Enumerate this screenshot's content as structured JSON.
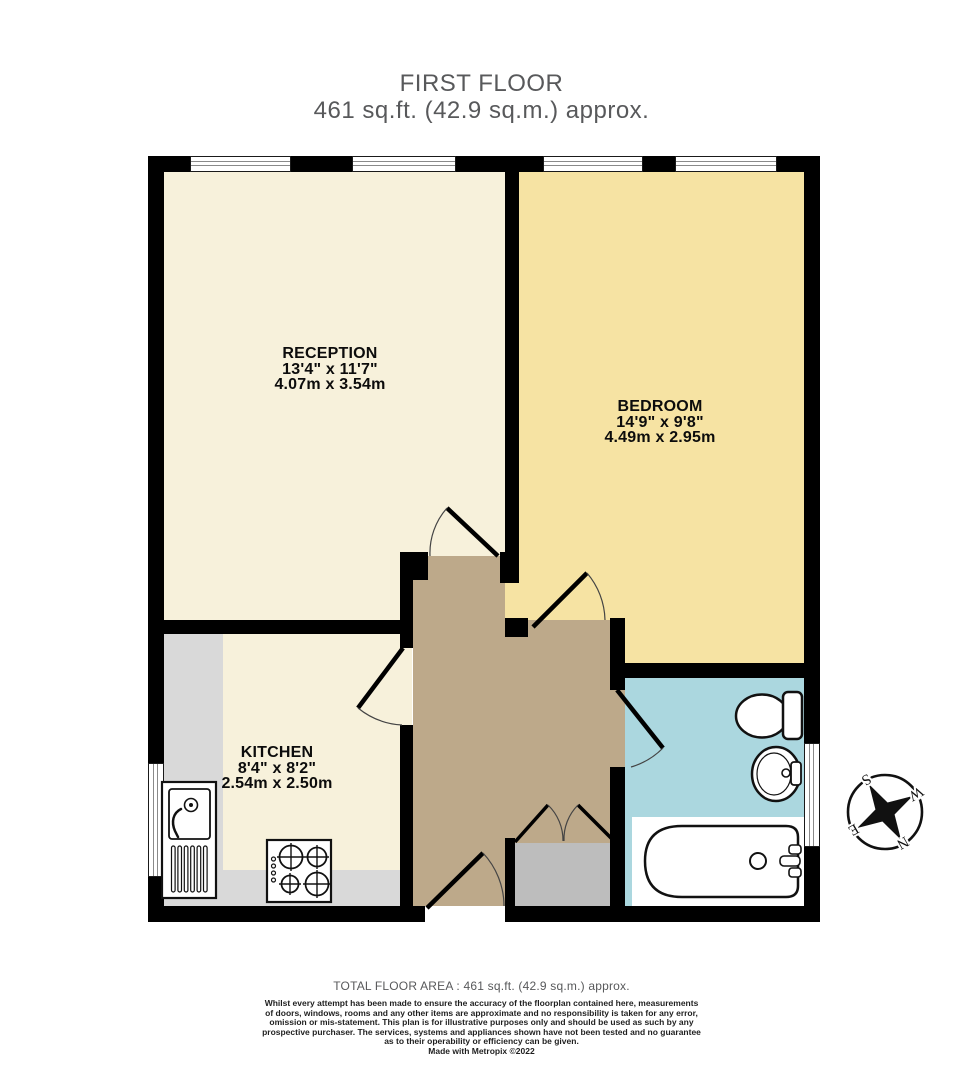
{
  "title": {
    "floor": "FIRST FLOOR",
    "area": "461 sq.ft. (42.9 sq.m.) approx."
  },
  "rooms": {
    "reception": {
      "name": "RECEPTION",
      "dims_imperial": "13'4\" x 11'7\"",
      "dims_metric": "4.07m x 3.54m",
      "floor_color": "#f7f1db"
    },
    "bedroom": {
      "name": "BEDROOM",
      "dims_imperial": "14'9\" x 9'8\"",
      "dims_metric": "4.49m x 2.95m",
      "floor_color": "#f6e3a3"
    },
    "kitchen": {
      "name": "KITCHEN",
      "dims_imperial": "8'4\" x 8'2\"",
      "dims_metric": "2.54m x 2.50m",
      "floor_color": "#f7f1db"
    },
    "bathroom": {
      "floor_color": "#abd7df"
    },
    "hallway": {
      "floor_color": "#bda98a"
    }
  },
  "fixtures": [
    "toilet",
    "wash-basin",
    "bathtub",
    "kitchen-sink",
    "hob",
    "built-in-cupboard"
  ],
  "compass": {
    "north": "N",
    "south": "S",
    "east": "E",
    "west": "W",
    "rotation_deg": 150
  },
  "footer": {
    "total_area": "TOTAL FLOOR AREA : 461 sq.ft. (42.9 sq.m.) approx.",
    "disclaimer_lines": [
      "Whilst every attempt has been made to ensure the accuracy of the floorplan contained here, measurements",
      "of doors, windows, rooms and any other items are approximate and no responsibility is taken for any error,",
      "omission or mis-statement. This plan is for illustrative purposes only and should be used as such by any",
      "prospective purchaser. The services, systems and appliances shown have not been tested and no guarantee",
      "as to their operability or efficiency can be given."
    ],
    "credit": "Made with Metropix ©2022"
  },
  "colors": {
    "wall": "#000000",
    "window": "#ffffff",
    "counter": "#d9d9d9",
    "cupboard": "#bdbdbd",
    "title_text": "#58595b",
    "label_text": "#0c0c0c"
  }
}
